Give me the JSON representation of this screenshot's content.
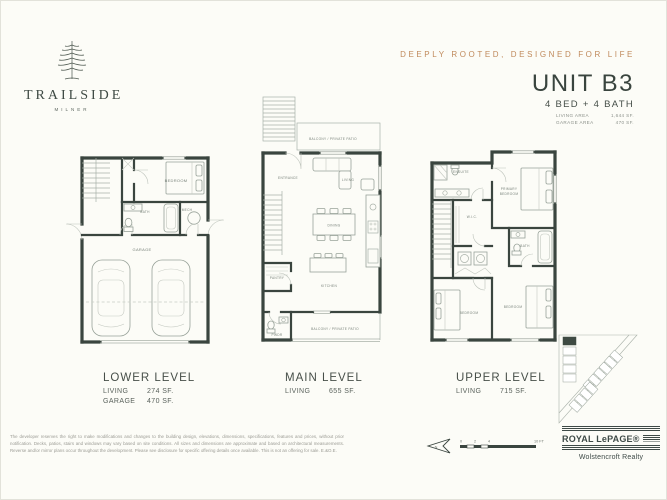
{
  "brand": {
    "name": "TRAILSIDE",
    "sub": "MILNER"
  },
  "header": {
    "tagline": "DEEPLY ROOTED, DESIGNED FOR LIFE",
    "unit": "UNIT B3",
    "beds_baths": "4 BED  +  4 BATH",
    "areas": [
      {
        "label": "LIVING AREA",
        "value": "1,644 SF."
      },
      {
        "label": "GARAGE AREA",
        "value": "470 SF."
      }
    ]
  },
  "plans": {
    "lower": {
      "title": "LOWER LEVEL",
      "stats": [
        {
          "label": "LIVING",
          "value": "274 SF."
        },
        {
          "label": "GARAGE",
          "value": "470 SF."
        }
      ],
      "rooms": {
        "bedroom": "BEDROOM",
        "bath": "BATH",
        "mech": "MECH",
        "garage": "GARAGE"
      }
    },
    "main": {
      "title": "MAIN LEVEL",
      "stats": [
        {
          "label": "LIVING",
          "value": "655 SF."
        }
      ],
      "rooms": {
        "balcony_top": "BALCONY / PRIVATE PATIO",
        "entrance": "ENTRANCE",
        "living": "LIVING",
        "dining": "DINING",
        "kitchen": "KITCHEN",
        "pantry": "PANTRY",
        "pwdr": "PWDR",
        "balcony_bottom": "BALCONY / PRIVATE PATIO"
      }
    },
    "upper": {
      "title": "UPPER LEVEL",
      "stats": [
        {
          "label": "LIVING",
          "value": "715 SF."
        }
      ],
      "rooms": {
        "ensuite": "ENSUITE",
        "primary_line1": "PRIMARY",
        "primary_line2": "BEDROOM",
        "wic": "W.I.C.",
        "bath": "BATH",
        "bedroom_left": "BEDROOM",
        "bedroom_right": "BEDROOM"
      }
    }
  },
  "footer": {
    "disclaimer": "The developer reserves the right to make modifications and changes to the building design, elevations, dimensions, specifications, features and prices, without prior notification. Decks, patios, stairs and windows may vary based on site conditions. All sizes and dimensions are approximate and based on architectural measurements. Reverse and/or mirror plans occur throughout the development. Please see disclosure for specific offering details once available. This is not an offering for sale. E.&O.E.",
    "north": "N",
    "scale": {
      "ticks": [
        "0",
        "2",
        "4"
      ],
      "end": "10 FT"
    },
    "brokerage": {
      "name": "ROYAL LePAGE®",
      "office": "Wolstencroft Realty"
    }
  },
  "colors": {
    "accent": "#c08a5c",
    "ink": "#3a453f",
    "wall": "#3a453f",
    "furniture": "#a9b1a9"
  }
}
